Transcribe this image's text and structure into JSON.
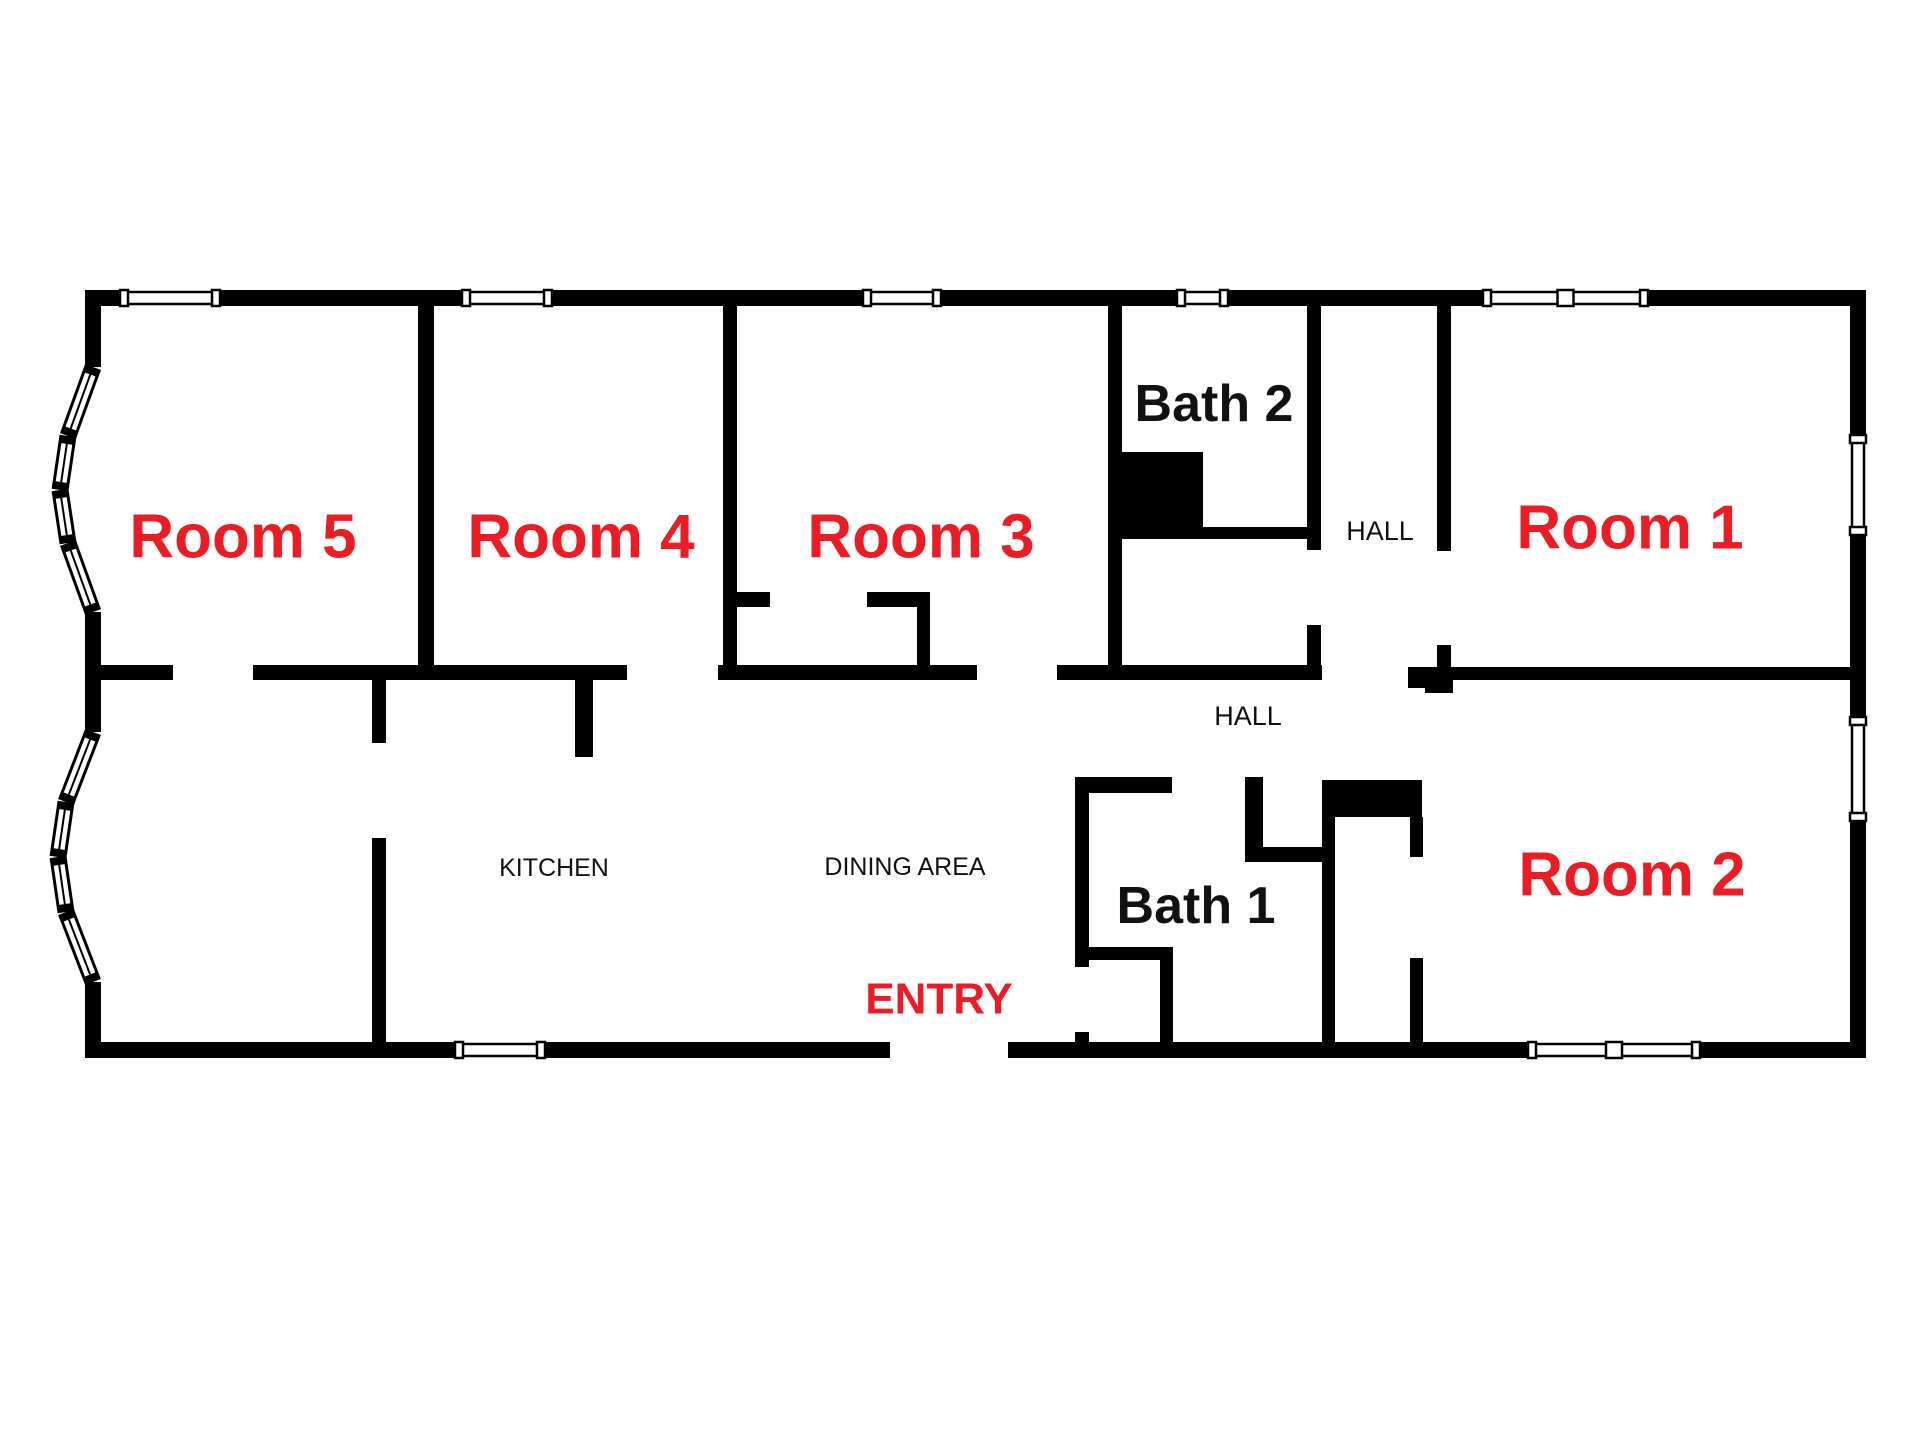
{
  "title": "Floor plan with labeled rooms",
  "colors": {
    "wall": "#000000",
    "background": "#ffffff",
    "accent_red": "#ec1c24",
    "label_black": "#111111"
  },
  "canvas": {
    "width": 1920,
    "height": 1440
  },
  "labels": [
    {
      "id": "room-5",
      "text": "Room 5",
      "x": 243,
      "y": 537,
      "color": "#ec1c24",
      "size": 62,
      "weight": "bold"
    },
    {
      "id": "room-4",
      "text": "Room 4",
      "x": 581,
      "y": 537,
      "color": "#ec1c24",
      "size": 62,
      "weight": "bold"
    },
    {
      "id": "room-3",
      "text": "Room 3",
      "x": 921,
      "y": 537,
      "color": "#ec1c24",
      "size": 62,
      "weight": "bold"
    },
    {
      "id": "room-1",
      "text": "Room 1",
      "x": 1630,
      "y": 528,
      "color": "#ec1c24",
      "size": 62,
      "weight": "bold"
    },
    {
      "id": "room-2",
      "text": "Room 2",
      "x": 1632,
      "y": 875,
      "color": "#ec1c24",
      "size": 62,
      "weight": "bold"
    },
    {
      "id": "bath-2",
      "text": "Bath 2",
      "x": 1214,
      "y": 404,
      "color": "#111111",
      "size": 52,
      "weight": "bold"
    },
    {
      "id": "bath-1",
      "text": "Bath 1",
      "x": 1196,
      "y": 906,
      "color": "#111111",
      "size": 52,
      "weight": "bold"
    },
    {
      "id": "hall-upper",
      "text": "HALL",
      "x": 1380,
      "y": 531,
      "color": "#111111",
      "size": 27,
      "weight": "normal"
    },
    {
      "id": "hall-lower",
      "text": "HALL",
      "x": 1248,
      "y": 716,
      "color": "#111111",
      "size": 27,
      "weight": "normal"
    },
    {
      "id": "kitchen",
      "text": "KITCHEN",
      "x": 554,
      "y": 868,
      "color": "#111111",
      "size": 25,
      "weight": "normal"
    },
    {
      "id": "dining-area",
      "text": "DINING AREA",
      "x": 905,
      "y": 867,
      "color": "#111111",
      "size": 25,
      "weight": "normal"
    },
    {
      "id": "entry",
      "text": "ENTRY",
      "x": 939,
      "y": 999,
      "color": "#ec1c24",
      "size": 44,
      "weight": "bold"
    }
  ],
  "plan": {
    "walls": [
      {
        "name": "outer-top",
        "x": 85,
        "y": 290,
        "w": 1781,
        "h": 16
      },
      {
        "name": "outer-right",
        "x": 1850,
        "y": 290,
        "w": 16,
        "h": 768
      },
      {
        "name": "outer-bottom",
        "x": 85,
        "y": 1042,
        "w": 1781,
        "h": 16
      },
      {
        "name": "outer-left-upper",
        "x": 85,
        "y": 290,
        "w": 16,
        "h": 77
      },
      {
        "name": "outer-left-mid",
        "x": 85,
        "y": 612,
        "w": 16,
        "h": 120
      },
      {
        "name": "outer-left-lower",
        "x": 85,
        "y": 982,
        "w": 16,
        "h": 76
      },
      {
        "name": "divider-room5-room4",
        "x": 418,
        "y": 306,
        "w": 16,
        "h": 374
      },
      {
        "name": "divider-room4-room3",
        "x": 723,
        "y": 306,
        "w": 14,
        "h": 374
      },
      {
        "name": "divider-room3-bath2",
        "x": 1108,
        "y": 306,
        "w": 14,
        "h": 374
      },
      {
        "name": "bath2-fixture-notch",
        "x": 1108,
        "y": 452,
        "w": 95,
        "h": 78
      },
      {
        "name": "bath2-subwall",
        "x": 1122,
        "y": 527,
        "w": 191,
        "h": 12
      },
      {
        "name": "bath2-right-upper",
        "x": 1307,
        "y": 306,
        "w": 14,
        "h": 244
      },
      {
        "name": "bath2-right-lower",
        "x": 1307,
        "y": 625,
        "w": 14,
        "h": 55
      },
      {
        "name": "room1-left-upper",
        "x": 1437,
        "y": 306,
        "w": 14,
        "h": 245
      },
      {
        "name": "room1-left-lower",
        "x": 1437,
        "y": 645,
        "w": 14,
        "h": 35
      },
      {
        "name": "hall-corner-piece",
        "x": 1408,
        "y": 667,
        "w": 45,
        "h": 26
      },
      {
        "name": "midwall-room5-left",
        "x": 101,
        "y": 665,
        "w": 72,
        "h": 15
      },
      {
        "name": "midwall-room5-room4",
        "x": 253,
        "y": 665,
        "w": 374,
        "h": 15
      },
      {
        "name": "midwall-room3",
        "x": 718,
        "y": 665,
        "w": 259,
        "h": 15
      },
      {
        "name": "midwall-bath2",
        "x": 1057,
        "y": 665,
        "w": 265,
        "h": 15
      },
      {
        "name": "midwall-room1-room2",
        "x": 1408,
        "y": 667,
        "w": 458,
        "h": 13
      },
      {
        "name": "room3-closet-stub-l",
        "x": 737,
        "y": 592,
        "w": 33,
        "h": 15
      },
      {
        "name": "room3-closet-stub-r",
        "x": 867,
        "y": 592,
        "w": 63,
        "h": 15
      },
      {
        "name": "room3-closet-right",
        "x": 917,
        "y": 592,
        "w": 13,
        "h": 88
      },
      {
        "name": "kitchen-divider-up",
        "x": 372,
        "y": 680,
        "w": 14,
        "h": 63
      },
      {
        "name": "kitchen-divider-low",
        "x": 372,
        "y": 838,
        "w": 14,
        "h": 204
      },
      {
        "name": "kitchen-dining-stub",
        "x": 575,
        "y": 680,
        "w": 18,
        "h": 77
      },
      {
        "name": "bath1-top",
        "x": 1075,
        "y": 777,
        "w": 97,
        "h": 16
      },
      {
        "name": "bath1-nook-vert",
        "x": 1245,
        "y": 777,
        "w": 18,
        "h": 85
      },
      {
        "name": "bath1-nook-horiz",
        "x": 1245,
        "y": 847,
        "w": 77,
        "h": 15
      },
      {
        "name": "bath1-left-upper",
        "x": 1075,
        "y": 777,
        "w": 14,
        "h": 190
      },
      {
        "name": "bath1-left-lower",
        "x": 1075,
        "y": 1032,
        "w": 14,
        "h": 26
      },
      {
        "name": "bath1-right",
        "x": 1322,
        "y": 780,
        "w": 13,
        "h": 262
      },
      {
        "name": "bath1-fixture-notch",
        "x": 1322,
        "y": 780,
        "w": 100,
        "h": 37
      },
      {
        "name": "bath1-shower-horiz",
        "x": 1082,
        "y": 947,
        "w": 91,
        "h": 13
      },
      {
        "name": "bath1-shower-vert",
        "x": 1160,
        "y": 947,
        "w": 13,
        "h": 95
      },
      {
        "name": "room2-left-upper",
        "x": 1410,
        "y": 817,
        "w": 13,
        "h": 40
      },
      {
        "name": "room2-left-lower",
        "x": 1410,
        "y": 958,
        "w": 13,
        "h": 84
      }
    ],
    "openings": [
      {
        "name": "room5-door",
        "x": 173,
        "y": 663,
        "w": 80,
        "h": 19
      },
      {
        "name": "room4-door",
        "x": 627,
        "y": 663,
        "w": 91,
        "h": 19
      },
      {
        "name": "room3-door",
        "x": 977,
        "y": 663,
        "w": 80,
        "h": 19
      },
      {
        "name": "hall-passage",
        "x": 1322,
        "y": 663,
        "w": 86,
        "h": 19
      },
      {
        "name": "bath2-area-door",
        "x": 1305,
        "y": 550,
        "w": 18,
        "h": 75
      },
      {
        "name": "room1-door",
        "x": 1435,
        "y": 551,
        "w": 18,
        "h": 94
      },
      {
        "name": "room2-hall-door",
        "x": 1408,
        "y": 688,
        "w": 17,
        "h": 92
      },
      {
        "name": "room2-closet-door",
        "x": 1408,
        "y": 857,
        "w": 17,
        "h": 101
      },
      {
        "name": "bath1-door",
        "x": 1172,
        "y": 775,
        "w": 73,
        "h": 20
      },
      {
        "name": "kitchen-door",
        "x": 370,
        "y": 743,
        "w": 18,
        "h": 95
      },
      {
        "name": "entry-closet-door",
        "x": 1073,
        "y": 967,
        "w": 18,
        "h": 65
      },
      {
        "name": "entry-opening",
        "x": 890,
        "y": 1040,
        "w": 118,
        "h": 20
      }
    ],
    "windows": [
      {
        "name": "window-room5-top",
        "x": 120,
        "y": 288,
        "w": 100,
        "h": 20,
        "orient": "h",
        "double": false
      },
      {
        "name": "window-room4-top",
        "x": 462,
        "y": 288,
        "w": 90,
        "h": 20,
        "orient": "h",
        "double": false
      },
      {
        "name": "window-room3-top",
        "x": 863,
        "y": 288,
        "w": 78,
        "h": 20,
        "orient": "h",
        "double": false
      },
      {
        "name": "window-bath2-top",
        "x": 1177,
        "y": 288,
        "w": 51,
        "h": 20,
        "orient": "h",
        "double": false
      },
      {
        "name": "window-room1-top",
        "x": 1483,
        "y": 288,
        "w": 165,
        "h": 20,
        "orient": "h",
        "double": true
      },
      {
        "name": "window-kitchen-bottom",
        "x": 455,
        "y": 1040,
        "w": 90,
        "h": 20,
        "orient": "h",
        "double": false
      },
      {
        "name": "window-room2-bottom",
        "x": 1528,
        "y": 1040,
        "w": 172,
        "h": 20,
        "orient": "h",
        "double": true
      },
      {
        "name": "window-room1-right",
        "x": 1848,
        "y": 435,
        "w": 20,
        "h": 100,
        "orient": "v",
        "double": false
      },
      {
        "name": "window-room2-right",
        "x": 1848,
        "y": 717,
        "w": 20,
        "h": 104,
        "orient": "v",
        "double": false
      }
    ],
    "bay_windows": [
      {
        "name": "bay-window-upper",
        "points": [
          [
            93,
            367
          ],
          [
            68,
            436
          ],
          [
            60,
            490
          ],
          [
            68,
            543
          ],
          [
            93,
            612
          ]
        ]
      },
      {
        "name": "bay-window-lower",
        "points": [
          [
            93,
            732
          ],
          [
            66,
            802
          ],
          [
            58,
            857
          ],
          [
            66,
            912
          ],
          [
            93,
            982
          ]
        ]
      }
    ]
  }
}
